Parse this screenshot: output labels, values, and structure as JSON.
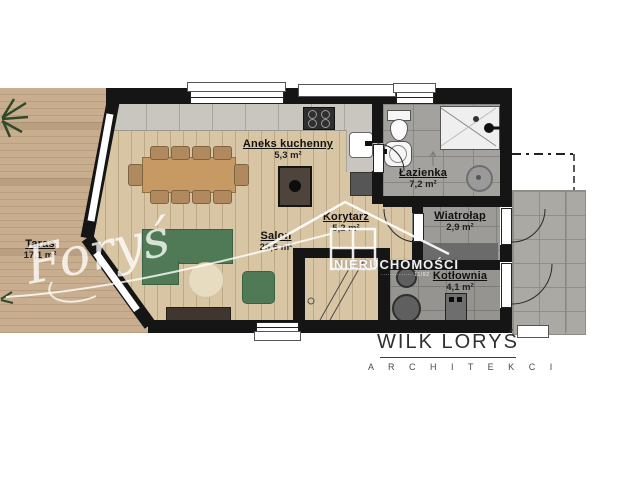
{
  "rooms": {
    "taras": {
      "name": "Taras",
      "area": "17,1 m²"
    },
    "aneks": {
      "name": "Aneks kuchenny",
      "area": "5,3 m²"
    },
    "salon": {
      "name": "Salon",
      "area": "28,6 m²"
    },
    "korytarz": {
      "name": "Korytarz",
      "area": "5,2 m²"
    },
    "lazienka": {
      "name": "Łazienka",
      "area": "7,2 m²"
    },
    "wiatrolap": {
      "name": "Wiatrołap",
      "area": "2,9 m²"
    },
    "kotlownia": {
      "name": "Kotłownia",
      "area": "4,1 m²"
    }
  },
  "watermark": {
    "agency": "NIERUCHOMOŚCI",
    "signature": "Foryś",
    "license": "·············· 11/92"
  },
  "logo": {
    "title": "WILK LORYŚ",
    "subtitle": "A R C H I T E K C I"
  },
  "colors": {
    "wall": "#151515",
    "wood_floor": "#d8c5a4",
    "deck": "#c8ae8e",
    "tile_gray": "#a4a29e",
    "sofa_green": "#4f7a55",
    "watermark_white": "#ffffff"
  }
}
